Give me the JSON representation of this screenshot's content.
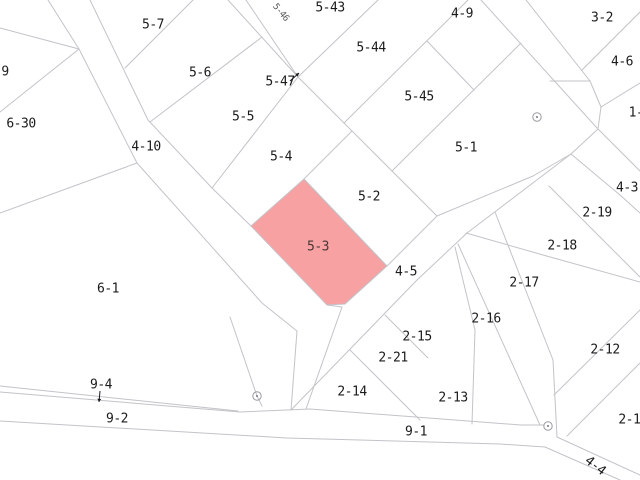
{
  "map": {
    "type": "cadastral-parcel-map",
    "background": "#ffffff",
    "line_color": "#c3c3c9",
    "label_color": "#1b1b1b",
    "highlight": {
      "parcel": "5-3",
      "fill": "#f7a1a3",
      "label_color": "#4a3636",
      "polygon": [
        [
          304,
          179
        ],
        [
          251,
          226
        ],
        [
          327,
          305
        ],
        [
          345,
          304
        ],
        [
          387,
          266
        ]
      ],
      "label_x": 318,
      "label_y": 247
    },
    "labels": [
      {
        "text": "5-7",
        "x": 153,
        "y": 25
      },
      {
        "text": "5-43",
        "x": 330,
        "y": 8
      },
      {
        "text": "5-46",
        "x": 280,
        "y": 13,
        "rotate": 50,
        "small": true
      },
      {
        "text": "4-9",
        "x": 462,
        "y": 14
      },
      {
        "text": "3-2",
        "x": 602,
        "y": 18
      },
      {
        "text": "5-44",
        "x": 371,
        "y": 48
      },
      {
        "text": "4-6",
        "x": 622,
        "y": 62
      },
      {
        "text": "5-6",
        "x": 200,
        "y": 73
      },
      {
        "text": "9",
        "x": 5,
        "y": 72
      },
      {
        "text": "5-47",
        "x": 280,
        "y": 82
      },
      {
        "text": "5-45",
        "x": 419,
        "y": 97
      },
      {
        "text": "1-",
        "x": 636,
        "y": 113
      },
      {
        "text": "5-5",
        "x": 243,
        "y": 117
      },
      {
        "text": "6-30",
        "x": 21,
        "y": 124
      },
      {
        "text": "4-10",
        "x": 146,
        "y": 147
      },
      {
        "text": "5-1",
        "x": 466,
        "y": 148
      },
      {
        "text": "5-4",
        "x": 281,
        "y": 157
      },
      {
        "text": "4-3",
        "x": 627,
        "y": 188
      },
      {
        "text": "5-2",
        "x": 369,
        "y": 197
      },
      {
        "text": "2-19",
        "x": 597,
        "y": 213
      },
      {
        "text": "2-18",
        "x": 562,
        "y": 246
      },
      {
        "text": "4-5",
        "x": 406,
        "y": 272
      },
      {
        "text": "2-17",
        "x": 524,
        "y": 283
      },
      {
        "text": "6-1",
        "x": 108,
        "y": 289
      },
      {
        "text": "2-16",
        "x": 486,
        "y": 319
      },
      {
        "text": "2-15",
        "x": 417,
        "y": 337
      },
      {
        "text": "2-12",
        "x": 605,
        "y": 350
      },
      {
        "text": "2-21",
        "x": 393,
        "y": 358
      },
      {
        "text": "9-4",
        "x": 101,
        "y": 385
      },
      {
        "text": "2-14",
        "x": 352,
        "y": 392
      },
      {
        "text": "2-13",
        "x": 453,
        "y": 398
      },
      {
        "text": "9-2",
        "x": 117,
        "y": 419
      },
      {
        "text": "2-11",
        "x": 633,
        "y": 420
      },
      {
        "text": "9-1",
        "x": 416,
        "y": 432
      },
      {
        "text": "4-4",
        "x": 595,
        "y": 466,
        "rotate": 38
      }
    ],
    "lines": [
      [
        [
          48,
          0
        ],
        [
          79,
          49
        ],
        [
          137,
          163
        ],
        [
          262,
          303
        ],
        [
          297,
          331
        ],
        [
          291,
          410
        ]
      ],
      [
        [
          90,
          0
        ],
        [
          148,
          120
        ],
        [
          212,
          188
        ],
        [
          251,
          226
        ]
      ],
      [
        [
          0,
          28
        ],
        [
          79,
          49
        ]
      ],
      [
        [
          0,
          112
        ],
        [
          79,
          49
        ]
      ],
      [
        [
          0,
          213
        ],
        [
          137,
          163
        ]
      ],
      [
        [
          125,
          68
        ],
        [
          193,
          0
        ]
      ],
      [
        [
          150,
          122
        ],
        [
          262,
          37
        ]
      ],
      [
        [
          212,
          188
        ],
        [
          298,
          77
        ]
      ],
      [
        [
          228,
          0
        ],
        [
          298,
          77
        ]
      ],
      [
        [
          246,
          0
        ],
        [
          298,
          77
        ]
      ],
      [
        [
          298,
          77
        ],
        [
          378,
          0
        ]
      ],
      [
        [
          298,
          77
        ],
        [
          437,
          216
        ]
      ],
      [
        [
          344,
          123
        ],
        [
          468,
          0
        ]
      ],
      [
        [
          392,
          171
        ],
        [
          521,
          43
        ]
      ],
      [
        [
          427,
          41
        ],
        [
          474,
          90
        ]
      ],
      [
        [
          481,
          0
        ],
        [
          597,
          128
        ]
      ],
      [
        [
          526,
          0
        ],
        [
          590,
          81
        ],
        [
          601,
          107
        ]
      ],
      [
        [
          550,
          81
        ],
        [
          590,
          81
        ]
      ],
      [
        [
          582,
          70
        ],
        [
          640,
          12
        ]
      ],
      [
        [
          601,
          107
        ],
        [
          640,
          83
        ]
      ],
      [
        [
          601,
          107
        ],
        [
          598,
          129
        ]
      ],
      [
        [
          598,
          129
        ],
        [
          640,
          171
        ]
      ],
      [
        [
          571,
          154
        ],
        [
          620,
          195
        ],
        [
          640,
          213
        ]
      ],
      [
        [
          598,
          129
        ],
        [
          571,
          154
        ]
      ],
      [
        [
          437,
          216
        ],
        [
          533,
          176
        ],
        [
          571,
          154
        ]
      ],
      [
        [
          387,
          266
        ],
        [
          437,
          216
        ]
      ],
      [
        [
          291,
          410
        ],
        [
          417,
          280
        ],
        [
          467,
          233
        ],
        [
          571,
          154
        ]
      ],
      [
        [
          304,
          179
        ],
        [
          352,
          131
        ]
      ],
      [
        [
          458,
          244
        ],
        [
          540,
          425
        ]
      ],
      [
        [
          495,
          212
        ],
        [
          553,
          360
        ],
        [
          557,
          437
        ]
      ],
      [
        [
          466,
          233
        ],
        [
          543,
          255
        ],
        [
          640,
          282
        ]
      ],
      [
        [
          549,
          186
        ],
        [
          640,
          277
        ]
      ],
      [
        [
          554,
          395
        ],
        [
          640,
          310
        ]
      ],
      [
        [
          567,
          436
        ],
        [
          640,
          363
        ]
      ],
      [
        [
          0,
          386
        ],
        [
          238,
          411
        ]
      ],
      [
        [
          0,
          392
        ],
        [
          240,
          412
        ],
        [
          310,
          409
        ],
        [
          521,
          425
        ]
      ],
      [
        [
          0,
          421
        ],
        [
          287,
          438
        ],
        [
          500,
          444
        ],
        [
          545,
          447
        ],
        [
          620,
          480
        ]
      ],
      [
        [
          557,
          437
        ],
        [
          640,
          475
        ]
      ],
      [
        [
          327,
          305
        ],
        [
          342,
          307
        ],
        [
          306,
          409
        ]
      ],
      [
        [
          230,
          317
        ],
        [
          257,
          396
        ],
        [
          262,
          406
        ]
      ],
      [
        [
          521,
          425
        ],
        [
          544,
          425
        ]
      ],
      [
        [
          385,
          315
        ],
        [
          428,
          358
        ]
      ],
      [
        [
          350,
          350
        ],
        [
          420,
          420
        ]
      ],
      [
        [
          455,
          247
        ],
        [
          475,
          330
        ],
        [
          472,
          424
        ]
      ]
    ],
    "survey_markers": [
      {
        "x": 537,
        "y": 117
      },
      {
        "x": 257,
        "y": 396
      },
      {
        "x": 548,
        "y": 426
      }
    ],
    "pointer_arrows": [
      {
        "x1": 290,
        "y1": 81,
        "x2": 299,
        "y2": 73
      },
      {
        "x1": 100,
        "y1": 391,
        "x2": 99,
        "y2": 402
      }
    ]
  }
}
